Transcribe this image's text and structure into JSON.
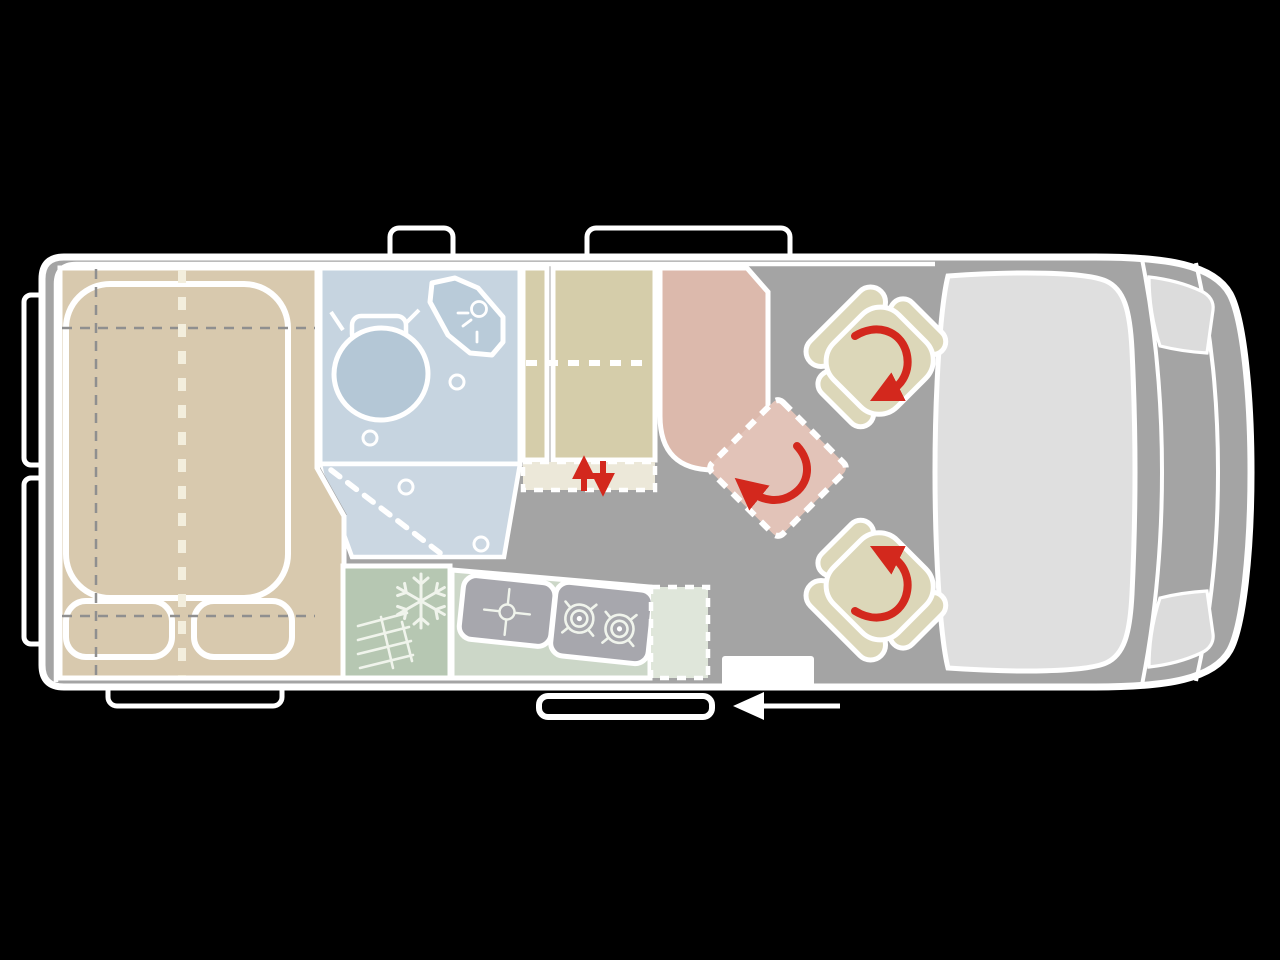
{
  "diagram": {
    "type": "camper-van floor plan, top view, nose facing right",
    "rooms": [
      "bed",
      "bathroom",
      "wardrobe",
      "kitchen",
      "dinette-table",
      "cab"
    ]
  },
  "colors": {
    "background": "#000000",
    "bump_fill": "#000000",
    "body": "#a4a4a4",
    "outline": "#ffffff",
    "bed": "#d8c9ae",
    "guide_gray": "#8f8f8f",
    "bed_dash": "#f3eedd",
    "bathroom": "#c6d4e0",
    "bathroom_floor": "#cbd7e2",
    "toilet": "#b4c7d6",
    "shower_tray": "#b9cbd9",
    "wardrobe": "#d5cdaa",
    "drawer": "#ece8d9",
    "fridge": "#b6c7b2",
    "counter": "#ccd7c8",
    "flap": "#dfe6da",
    "appliance": "#a7a7ad",
    "table": "#dcb9ac",
    "swivel_pad": "#e2c3b8",
    "seat": "#dcd7b9",
    "red": "#d3281d",
    "windshield": "#dfdfdf",
    "headlight": "#dcdcdc",
    "icon_light": "#f0f4ec"
  },
  "icons": {
    "fridge": "snowflake-icon",
    "sink": "faucet-cross-icon",
    "stove": "two-burner-icon",
    "shower": "shower-spray-icon",
    "wardrobe_bed_lift": "up-down-red-arrows-icon",
    "table_swivel": "curved-red-arrow-icon",
    "seat_swivel": "curved-red-arrow-icon",
    "sliding_door": "left-white-arrow-icon"
  }
}
